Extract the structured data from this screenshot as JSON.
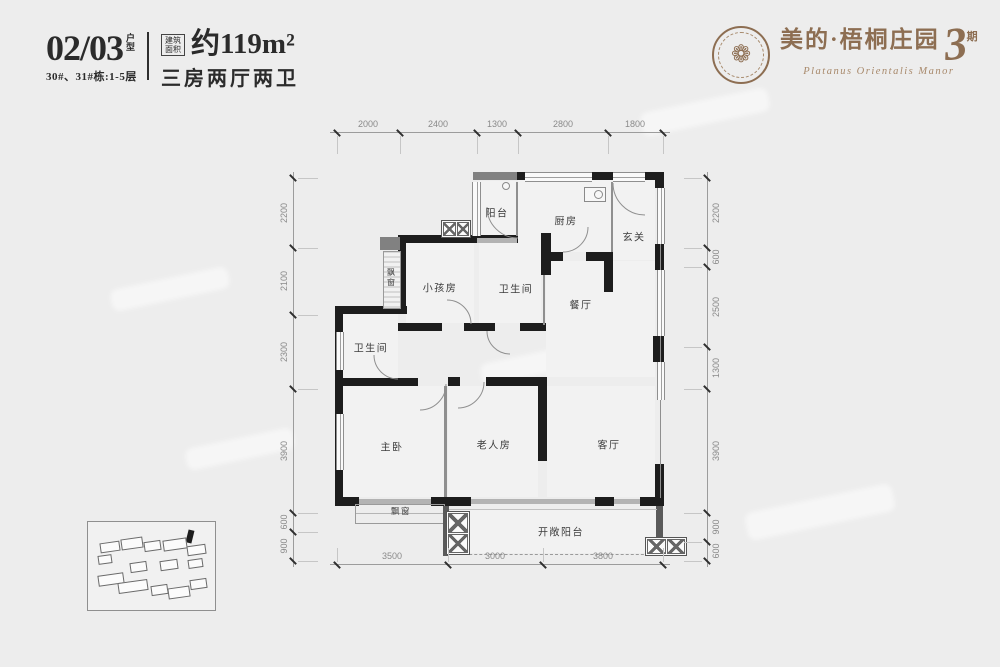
{
  "header": {
    "unit_number": "02/03",
    "unit_type_label": "户型",
    "buildings": "30#、31#栋:1-5层",
    "area_tag_label": "建筑面积",
    "area_value": "约119m²",
    "layout_text": "三房两厅两卫"
  },
  "logo": {
    "brand": "美的·梧桐庄园",
    "phase_number": "3",
    "phase_suffix": "期",
    "subtitle": "Platanus Orientalis Manor",
    "color": "#8d6e52"
  },
  "floorplan": {
    "rooms": [
      {
        "label": "阳台"
      },
      {
        "label": "厨房"
      },
      {
        "label": "玄关"
      },
      {
        "label": "小孩房"
      },
      {
        "label": "卫生间"
      },
      {
        "label": "餐厅"
      },
      {
        "label": "卫生间"
      },
      {
        "label": "主卧"
      },
      {
        "label": "老人房"
      },
      {
        "label": "客厅"
      },
      {
        "label": "飘窗"
      },
      {
        "label": "开敞阳台"
      },
      {
        "label": "飘窗"
      }
    ],
    "dimensions": {
      "top": [
        "2000",
        "2400",
        "1300",
        "2800",
        "1800"
      ],
      "bottom": [
        "3500",
        "3000",
        "3800"
      ],
      "left": [
        "2200",
        "2100",
        "2300",
        "3900",
        "600",
        "900"
      ],
      "right": [
        "2200",
        "600",
        "2500",
        "1300",
        "3900",
        "900",
        "600"
      ]
    }
  }
}
